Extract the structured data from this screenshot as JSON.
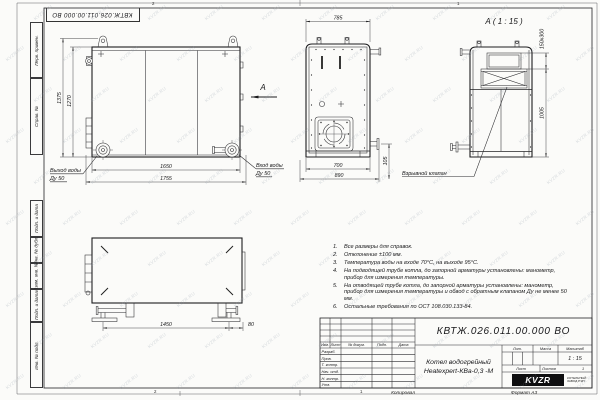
{
  "sheet": {
    "stamp_doc_number": "КВТЖ.026.011.00.000 ВО",
    "watermark": "KVZR.RU",
    "copy_label": "Копировал",
    "format_label": "Формат А3",
    "zone_top_left": "2",
    "zone_top_right": "1",
    "zone_bottom_left": "2",
    "zone_bottom_mid": "1"
  },
  "margin_labels": [
    "Перв. примен.",
    "Справ. №",
    "Подп. и дата",
    "Инв. № дубл.",
    "Взам. инв. №",
    "Подп. и дата",
    "Инв. № подл."
  ],
  "views": {
    "front": {
      "dim_height_outer": "1375",
      "dim_height_inner": "1270",
      "dim_width_inner": "1650",
      "dim_width_outer": "1755",
      "outlet_line1": "Выход воды",
      "outlet_line2": "Ду 50",
      "inlet_line1": "Вход воды",
      "inlet_line2": "Ду 50",
      "view_arrow": "А"
    },
    "side": {
      "dim_top_width": "785",
      "dim_bottom_inner": "700",
      "dim_bottom_outer": "890",
      "dim_drain": "105"
    },
    "detail": {
      "title": "А ( 1 : 15 )",
      "dim_valve": "150x300",
      "dim_height": "1005",
      "valve_label": "Взрывной клапан"
    },
    "top": {
      "dim_leg_span": "1450",
      "dim_leg_offset": "80"
    }
  },
  "notes": [
    "Все размеры для справок.",
    "Отклонение ±100 мм.",
    "Температура воды на входе 70°С, на выходе 95°С.",
    "На подводящей трубе котла, до запорной арматуры установлены: манометр, прибор для измерения температуры.",
    "На отводящей трубе котла, до запорной арматуры установлены: манометр, прибор для измерения температуры и обвод с обратным клапаном Ду не менее 50 мм.",
    "Остальные требования по ОСТ 108.030.133-84."
  ],
  "title_block": {
    "doc_number": "КВТЖ.026.011.00.000 ВО",
    "product_name_line1": "Котел водогрейный",
    "product_name_line2": "Heatexpert-КВа-0,3 -М",
    "header_cols": [
      "Изм.",
      "Лист",
      "№ докум.",
      "Подп.",
      "Дата"
    ],
    "signature_rows": [
      "Разраб.",
      "Пров.",
      "Т. контр.",
      "Нач. отд.",
      "Н. контр.",
      "Утв."
    ],
    "lit_label": "Лит.",
    "mass_label": "Масса",
    "scale_label": "Масштаб",
    "scale_value": "1 : 15",
    "sheet_label": "Лист",
    "sheets_label": "Листов",
    "sheets_value": "1",
    "logo_text": "KVZR",
    "logo_caption_line1": "КОТЕЛЬНЫЙ",
    "logo_caption_line2": "ЗАВОД РЭП"
  }
}
